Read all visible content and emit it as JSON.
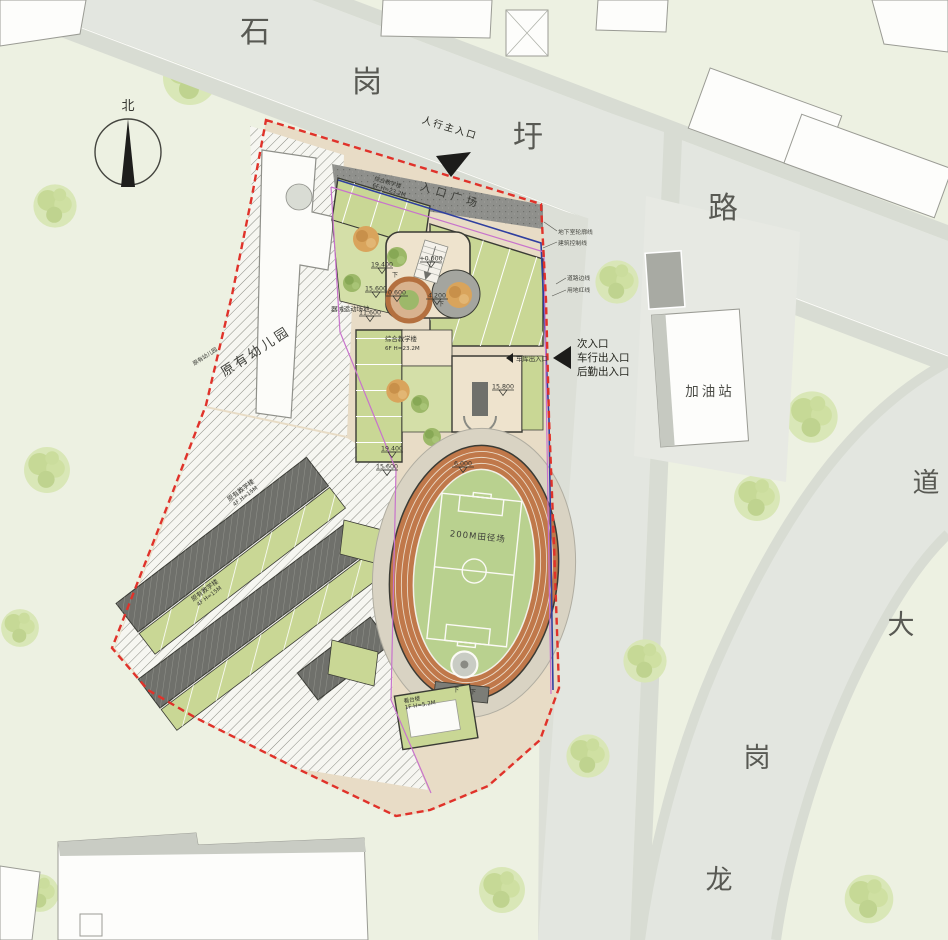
{
  "north": {
    "label": "北"
  },
  "roads": {
    "shigangxu": {
      "chars": [
        "石",
        "岗",
        "圩",
        "路"
      ]
    },
    "longgang": {
      "chars": [
        "龙",
        "岗",
        "大",
        "道"
      ]
    }
  },
  "entrances": {
    "pedestrian_main": "人行主入口",
    "entrance_plaza": "入口广场",
    "secondary": [
      "次入口",
      "车行出入口",
      "后勤出入口"
    ],
    "garage": "车库出入口"
  },
  "lines": {
    "basement_outline": "地下室轮廓线",
    "building_control": "建筑控制线",
    "road_edge": "道路边线",
    "site_red_line": "用地红线"
  },
  "labels": {
    "existing_kindergarten": "原有幼儿园",
    "existing_kindergarten_2": "原有幼儿园",
    "teaching_building": {
      "name": "综合教学楼",
      "spec": "6F H=23.2M"
    },
    "teaching_building_2": {
      "name": "综合教学楼",
      "spec": "6F H=23.2M"
    },
    "equipment_field": "器械运动场地",
    "existing_teaching_1": {
      "name": "原有教学楼",
      "spec": "4F H=15M"
    },
    "existing_teaching_2": {
      "name": "原有教学楼",
      "spec": "4F H=15M"
    },
    "track_field": "200M田径场",
    "grandstand": {
      "name": "看台楼",
      "spec": "1F H=5.2M"
    },
    "gas_station": "加油站",
    "down": "下"
  },
  "elevations": [
    "19.400",
    "15.600",
    "11.600",
    "+0.000",
    "0.600",
    "4.200",
    "19.400",
    "15.600",
    "6.000",
    "15.800"
  ],
  "colors": {
    "background": "#edf1e2",
    "road": "#e3e6e0",
    "sidewalk": "#d8dcd3",
    "site_paving": "#e8dcc6",
    "roof_green": "#c9d795",
    "plaza_gray": "#8f908c",
    "track_orange": "#c0784a",
    "infield_green": "#b9d18f",
    "red_line": "#e0322a",
    "control_blue": "#2f3f9f",
    "magenta_line": "#c873cc"
  }
}
